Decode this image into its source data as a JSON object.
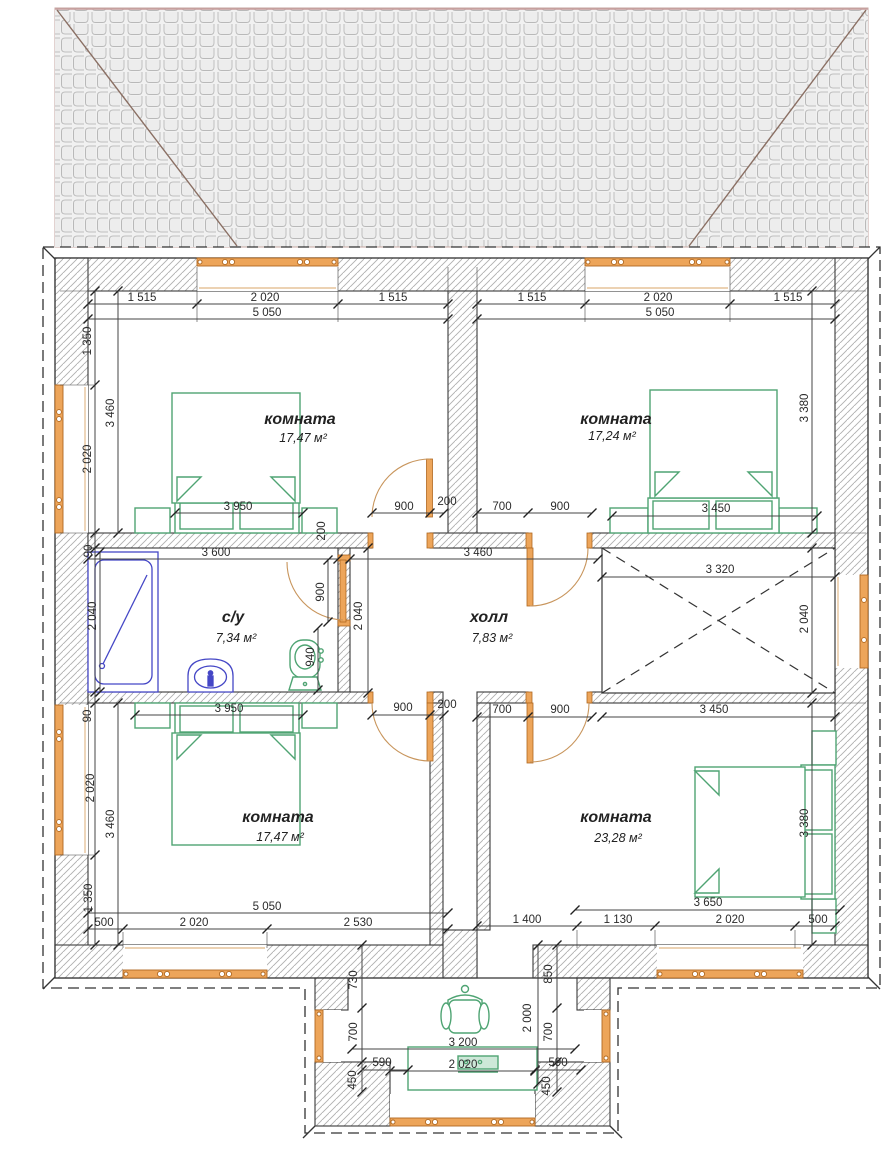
{
  "drawing": {
    "type": "architectural-floor-plan",
    "units": "mm"
  },
  "rooms": [
    {
      "id": "room-top-left",
      "name": "комната",
      "area": "17,47 м²"
    },
    {
      "id": "room-top-right",
      "name": "комната",
      "area": "17,24 м²"
    },
    {
      "id": "bathroom",
      "name": "с/у",
      "area": "7,34 м²"
    },
    {
      "id": "hall",
      "name": "холл",
      "area": "7,83 м²"
    },
    {
      "id": "room-bottom-left",
      "name": "комната",
      "area": "17,47 м²"
    },
    {
      "id": "room-bottom-right",
      "name": "комната",
      "area": "23,28 м²"
    }
  ],
  "fixtures": [
    "double-bed",
    "double-bed",
    "double-bed",
    "double-bed",
    "bathtub",
    "sink",
    "toilet",
    "armchair",
    "table",
    "stair-void",
    "window",
    "door"
  ],
  "colors": {
    "window_fill": "#EDA55A",
    "window_stroke": "#B06820",
    "door_arc": "#C8955C",
    "furniture_green": "#4FA473",
    "sanitary_blue": "#4547C6",
    "wall_line": "#3a3a3a",
    "hatch": "#b0b0b0",
    "roof_hip": "#8a6f63",
    "dim_text": "#2b2b2b"
  },
  "dims": [
    {
      "v": "1 515",
      "x": 142,
      "y": 301,
      "r": 0
    },
    {
      "v": "2 020",
      "x": 265,
      "y": 301,
      "r": 0
    },
    {
      "v": "1 515",
      "x": 393,
      "y": 301,
      "r": 0
    },
    {
      "v": "5 050",
      "x": 267,
      "y": 316,
      "r": 0
    },
    {
      "v": "1 515",
      "x": 532,
      "y": 301,
      "r": 0
    },
    {
      "v": "2 020",
      "x": 658,
      "y": 301,
      "r": 0
    },
    {
      "v": "1 515",
      "x": 788,
      "y": 301,
      "r": 0
    },
    {
      "v": "5 050",
      "x": 660,
      "y": 316,
      "r": 0
    },
    {
      "v": "1 350",
      "x": 91,
      "y": 341,
      "r": 90
    },
    {
      "v": "3 460",
      "x": 114,
      "y": 413,
      "r": 90
    },
    {
      "v": "2 020",
      "x": 91,
      "y": 459,
      "r": 90
    },
    {
      "v": "3 950",
      "x": 238,
      "y": 510,
      "r": 0
    },
    {
      "v": "900",
      "x": 404,
      "y": 510,
      "r": 0
    },
    {
      "v": "200",
      "x": 447,
      "y": 505,
      "r": 0
    },
    {
      "v": "200",
      "x": 325,
      "y": 531,
      "r": 90
    },
    {
      "v": "3 380",
      "x": 808,
      "y": 408,
      "r": 90
    },
    {
      "v": "700",
      "x": 502,
      "y": 510,
      "r": 0
    },
    {
      "v": "900",
      "x": 560,
      "y": 510,
      "r": 0
    },
    {
      "v": "3 450",
      "x": 716,
      "y": 512,
      "r": 0
    },
    {
      "v": "3 600",
      "x": 216,
      "y": 556,
      "r": 0
    },
    {
      "v": "2 040",
      "x": 96,
      "y": 616,
      "r": 90
    },
    {
      "v": "90",
      "x": 92,
      "y": 551,
      "r": 90
    },
    {
      "v": "900",
      "x": 324,
      "y": 592,
      "r": 90
    },
    {
      "v": "940",
      "x": 314,
      "y": 657,
      "r": 90
    },
    {
      "v": "3 460",
      "x": 478,
      "y": 556,
      "r": 0
    },
    {
      "v": "2 040",
      "x": 362,
      "y": 616,
      "r": 90
    },
    {
      "v": "3 320",
      "x": 720,
      "y": 573,
      "r": 0
    },
    {
      "v": "2 040",
      "x": 808,
      "y": 619,
      "r": 90
    },
    {
      "v": "3 950",
      "x": 229,
      "y": 712,
      "r": 0
    },
    {
      "v": "90",
      "x": 91,
      "y": 716,
      "r": 90
    },
    {
      "v": "900",
      "x": 403,
      "y": 711,
      "r": 0
    },
    {
      "v": "200",
      "x": 447,
      "y": 708,
      "r": 0
    },
    {
      "v": "700",
      "x": 502,
      "y": 713,
      "r": 0
    },
    {
      "v": "900",
      "x": 560,
      "y": 713,
      "r": 0
    },
    {
      "v": "3 450",
      "x": 714,
      "y": 713,
      "r": 0
    },
    {
      "v": "2 020",
      "x": 94,
      "y": 788,
      "r": 90
    },
    {
      "v": "3 460",
      "x": 114,
      "y": 824,
      "r": 90
    },
    {
      "v": "1 350",
      "x": 92,
      "y": 898,
      "r": 90
    },
    {
      "v": "3 380",
      "x": 808,
      "y": 823,
      "r": 90
    },
    {
      "v": "5 050",
      "x": 267,
      "y": 910,
      "r": 0
    },
    {
      "v": "500",
      "x": 104,
      "y": 926,
      "r": 0
    },
    {
      "v": "2 020",
      "x": 194,
      "y": 926,
      "r": 0
    },
    {
      "v": "2 530",
      "x": 358,
      "y": 926,
      "r": 0
    },
    {
      "v": "3 650",
      "x": 708,
      "y": 906,
      "r": 0
    },
    {
      "v": "1 400",
      "x": 527,
      "y": 923,
      "r": 0
    },
    {
      "v": "1 130",
      "x": 618,
      "y": 923,
      "r": 0
    },
    {
      "v": "2 020",
      "x": 730,
      "y": 923,
      "r": 0
    },
    {
      "v": "500",
      "x": 818,
      "y": 923,
      "r": 0
    },
    {
      "v": "730",
      "x": 357,
      "y": 980,
      "r": 90
    },
    {
      "v": "700",
      "x": 357,
      "y": 1032,
      "r": 90
    },
    {
      "v": "450",
      "x": 356,
      "y": 1080,
      "r": 90
    },
    {
      "v": "590",
      "x": 382,
      "y": 1066,
      "r": 0
    },
    {
      "v": "850",
      "x": 552,
      "y": 974,
      "r": 90
    },
    {
      "v": "2 000",
      "x": 531,
      "y": 1018,
      "r": 90
    },
    {
      "v": "700",
      "x": 552,
      "y": 1032,
      "r": 90
    },
    {
      "v": "590",
      "x": 558,
      "y": 1066,
      "r": 0
    },
    {
      "v": "450",
      "x": 550,
      "y": 1086,
      "r": 90
    },
    {
      "v": "3 200",
      "x": 463,
      "y": 1046,
      "r": 0
    },
    {
      "v": "2 020",
      "x": 463,
      "y": 1068,
      "r": 0
    }
  ]
}
